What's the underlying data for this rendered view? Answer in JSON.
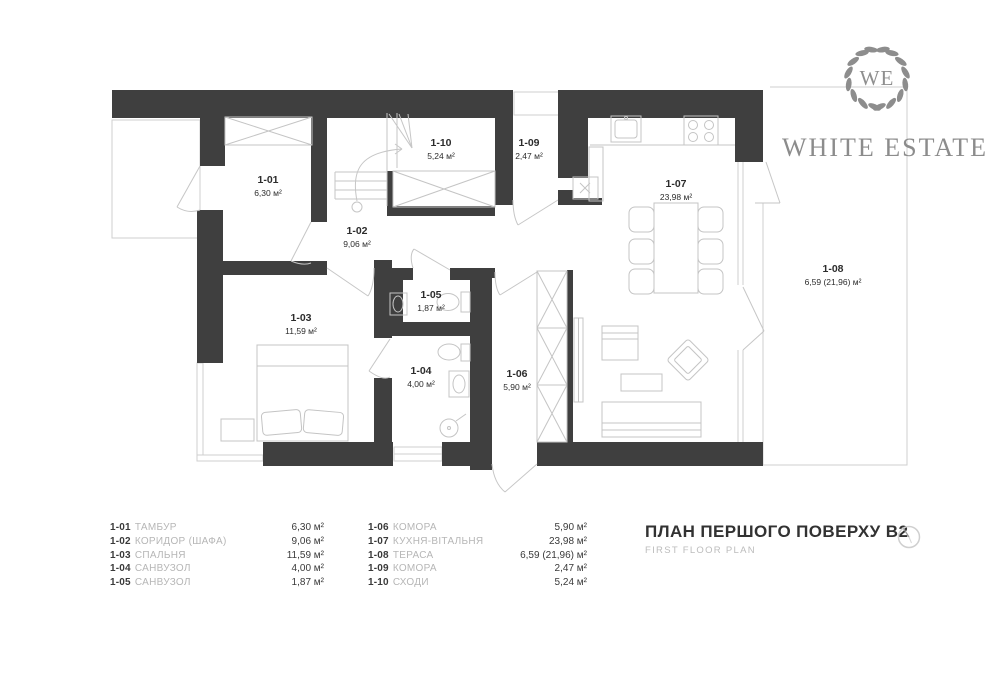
{
  "logo": {
    "monogram": "WE",
    "name": "WHITE ESTATE"
  },
  "title": {
    "main": "ПЛАН ПЕРШОГО ПОВЕРХУ В2",
    "sub": "FIRST FLOOR PLAN"
  },
  "icons": {
    "north": "compass-icon",
    "logo": "laurel-wreath-icon"
  },
  "colors": {
    "wall": "#3f3f3f",
    "thin_line": "#c9c9c9",
    "text_dark": "#2d2d2d",
    "text_muted": "#b6b6b6",
    "logo_gray": "#8c8c8c"
  },
  "rooms": [
    {
      "code": "1-01",
      "name": "ТАМБУР",
      "area": "6,30 м²"
    },
    {
      "code": "1-02",
      "name": "КОРИДОР (ШАФА)",
      "area": "9,06 м²"
    },
    {
      "code": "1-03",
      "name": "СПАЛЬНЯ",
      "area": "11,59 м²"
    },
    {
      "code": "1-04",
      "name": "САНВУЗОЛ",
      "area": "4,00 м²"
    },
    {
      "code": "1-05",
      "name": "САНВУЗОЛ",
      "area": "1,87 м²"
    },
    {
      "code": "1-06",
      "name": "КОМОРА",
      "area": "5,90 м²"
    },
    {
      "code": "1-07",
      "name": "КУХНЯ-ВІТАЛЬНЯ",
      "area": "23,98 м²"
    },
    {
      "code": "1-08",
      "name": "ТЕРАСА",
      "area": "6,59 (21,96) м²"
    },
    {
      "code": "1-09",
      "name": "КОМОРА",
      "area": "2,47 м²"
    },
    {
      "code": "1-10",
      "name": "СХОДИ",
      "area": "5,24 м²"
    }
  ]
}
